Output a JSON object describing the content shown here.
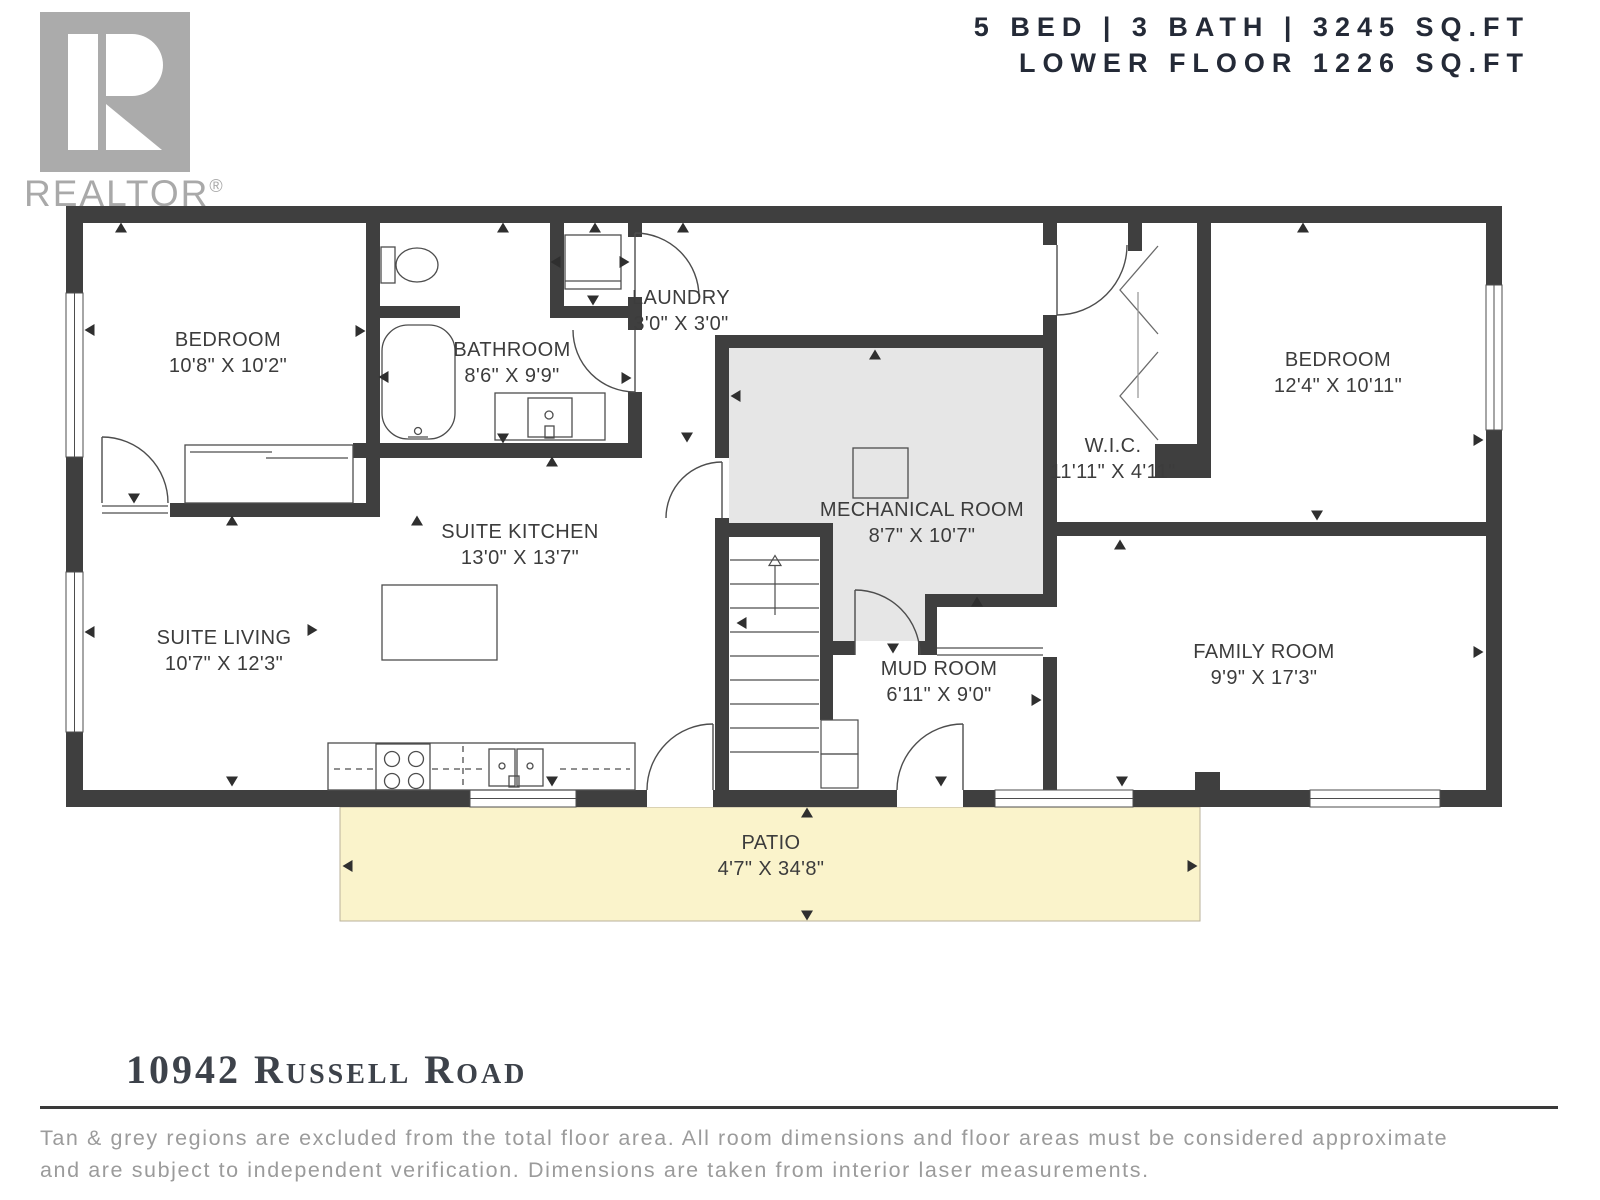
{
  "header": {
    "line1": "5 BED | 3 BATH | 3245 SQ.FT",
    "line2": "LOWER FLOOR 1226 SQ.FT"
  },
  "logo": {
    "brand": "REALTOR",
    "registered": "®"
  },
  "plan": {
    "rooms": [
      {
        "id": "bedroom-1",
        "name": "BEDROOM",
        "dims": "10'8\" X 10'2\""
      },
      {
        "id": "bathroom",
        "name": "BATHROOM",
        "dims": "8'6\" X 9'9\""
      },
      {
        "id": "laundry",
        "name": "LAUNDRY",
        "dims": "3'0\" X 3'0\""
      },
      {
        "id": "bedroom-2",
        "name": "BEDROOM",
        "dims": "12'4\" X 10'11\""
      },
      {
        "id": "wic",
        "name": "W.I.C.",
        "dims": "11'11\" X 4'11\""
      },
      {
        "id": "mechanical-room",
        "name": "MECHANICAL ROOM",
        "dims": "8'7\" X 10'7\""
      },
      {
        "id": "suite-kitchen",
        "name": "SUITE KITCHEN",
        "dims": "13'0\" X 13'7\""
      },
      {
        "id": "suite-living",
        "name": "SUITE LIVING",
        "dims": "10'7\" X 12'3\""
      },
      {
        "id": "mud-room",
        "name": "MUD ROOM",
        "dims": "6'11\" X 9'0\""
      },
      {
        "id": "family-room",
        "name": "FAMILY ROOM",
        "dims": "9'9\" X 17'3\""
      },
      {
        "id": "patio",
        "name": "PATIO",
        "dims": "4'7\" X 34'8\""
      }
    ],
    "colors": {
      "wall": "#3f3f3f",
      "mechanical_fill": "#e6e6e6",
      "patio_fill": "#faf3cb",
      "label": "#3c3c3c"
    }
  },
  "footer": {
    "address": "10942 Russell Road",
    "disclaimer_line1": "Tan & grey regions are excluded from the total floor area. All room dimensions and floor areas must be considered approximate",
    "disclaimer_line2": "and are subject to independent verification. Dimensions are taken from interior laser measurements."
  }
}
